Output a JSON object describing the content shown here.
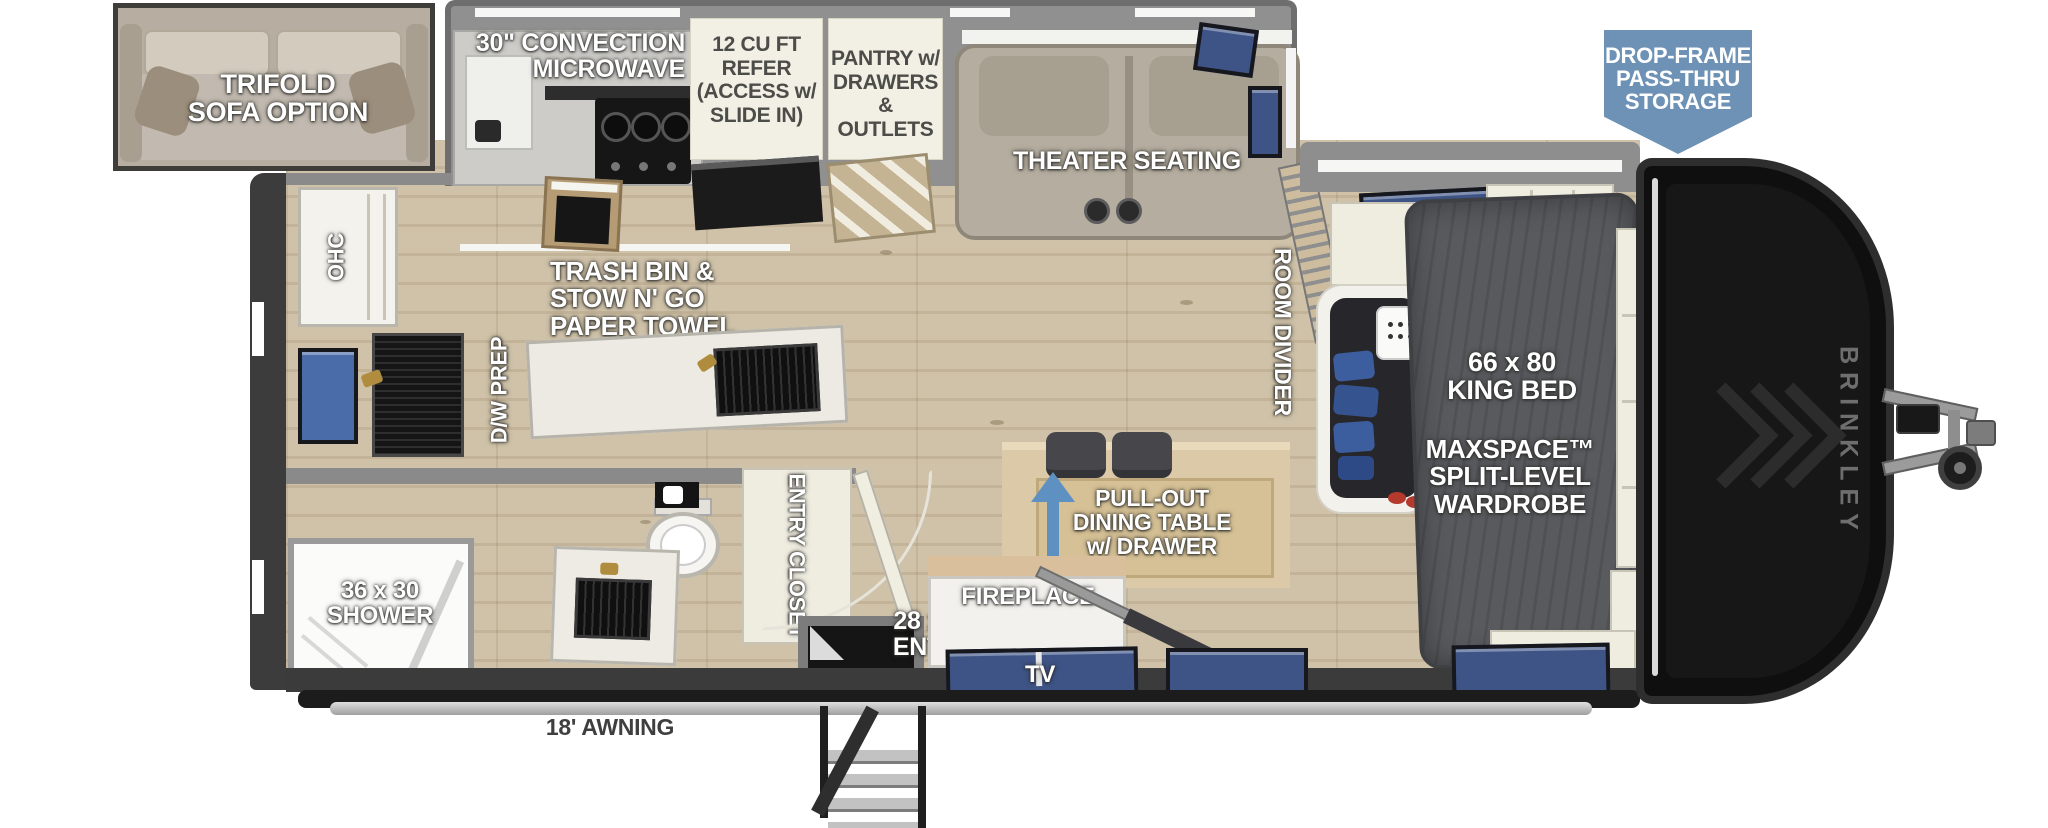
{
  "inset": {
    "lines": [
      "TRIFOLD",
      "SOFA OPTION"
    ]
  },
  "kitchen": {
    "microwave": [
      "30\" CONVECTION",
      "MICROWAVE"
    ],
    "refer": [
      "12 CU FT",
      "REFER",
      "(ACCESS w/",
      "SLIDE IN)"
    ],
    "pantry": [
      "PANTRY w/",
      "DRAWERS",
      "& OUTLETS"
    ],
    "trash": [
      "TRASH BIN &",
      "STOW N' GO",
      "PAPER TOWEL"
    ],
    "dw_prep": "D/W PREP",
    "ohc": "OHC"
  },
  "living": {
    "theater": "THEATER SEATING",
    "room_divider": "ROOM DIVIDER",
    "dinette": [
      "PULL-OUT",
      "DINING TABLE",
      "w/ DRAWER"
    ],
    "fireplace": "FIREPLACE",
    "tv": "TV"
  },
  "bedroom": {
    "bed": [
      "66 x 80",
      "KING BED"
    ],
    "wardrobe": [
      "MAXSPACE™",
      "SPLIT-LEVEL",
      "WARDROBE"
    ]
  },
  "bath": {
    "shower": [
      "36 x 30",
      "SHOWER"
    ],
    "entry_closet": "ENTRY CLOSET"
  },
  "entry": {
    "size": [
      "28 x 72",
      "ENTRY"
    ]
  },
  "exterior": {
    "storage": [
      "DROP-FRAME",
      "PASS-THRU",
      "STORAGE"
    ],
    "awning": "18' AWNING",
    "brand": "BRINKLEY"
  },
  "colors": {
    "storage_banner": "#6d92b6",
    "arrow_blue": "#5e90c1",
    "window_blue": "#3e5486",
    "cream_label": "#f2efe4",
    "wood_floor": "#cdbfa6",
    "bed_charcoal": "#595a5e"
  }
}
